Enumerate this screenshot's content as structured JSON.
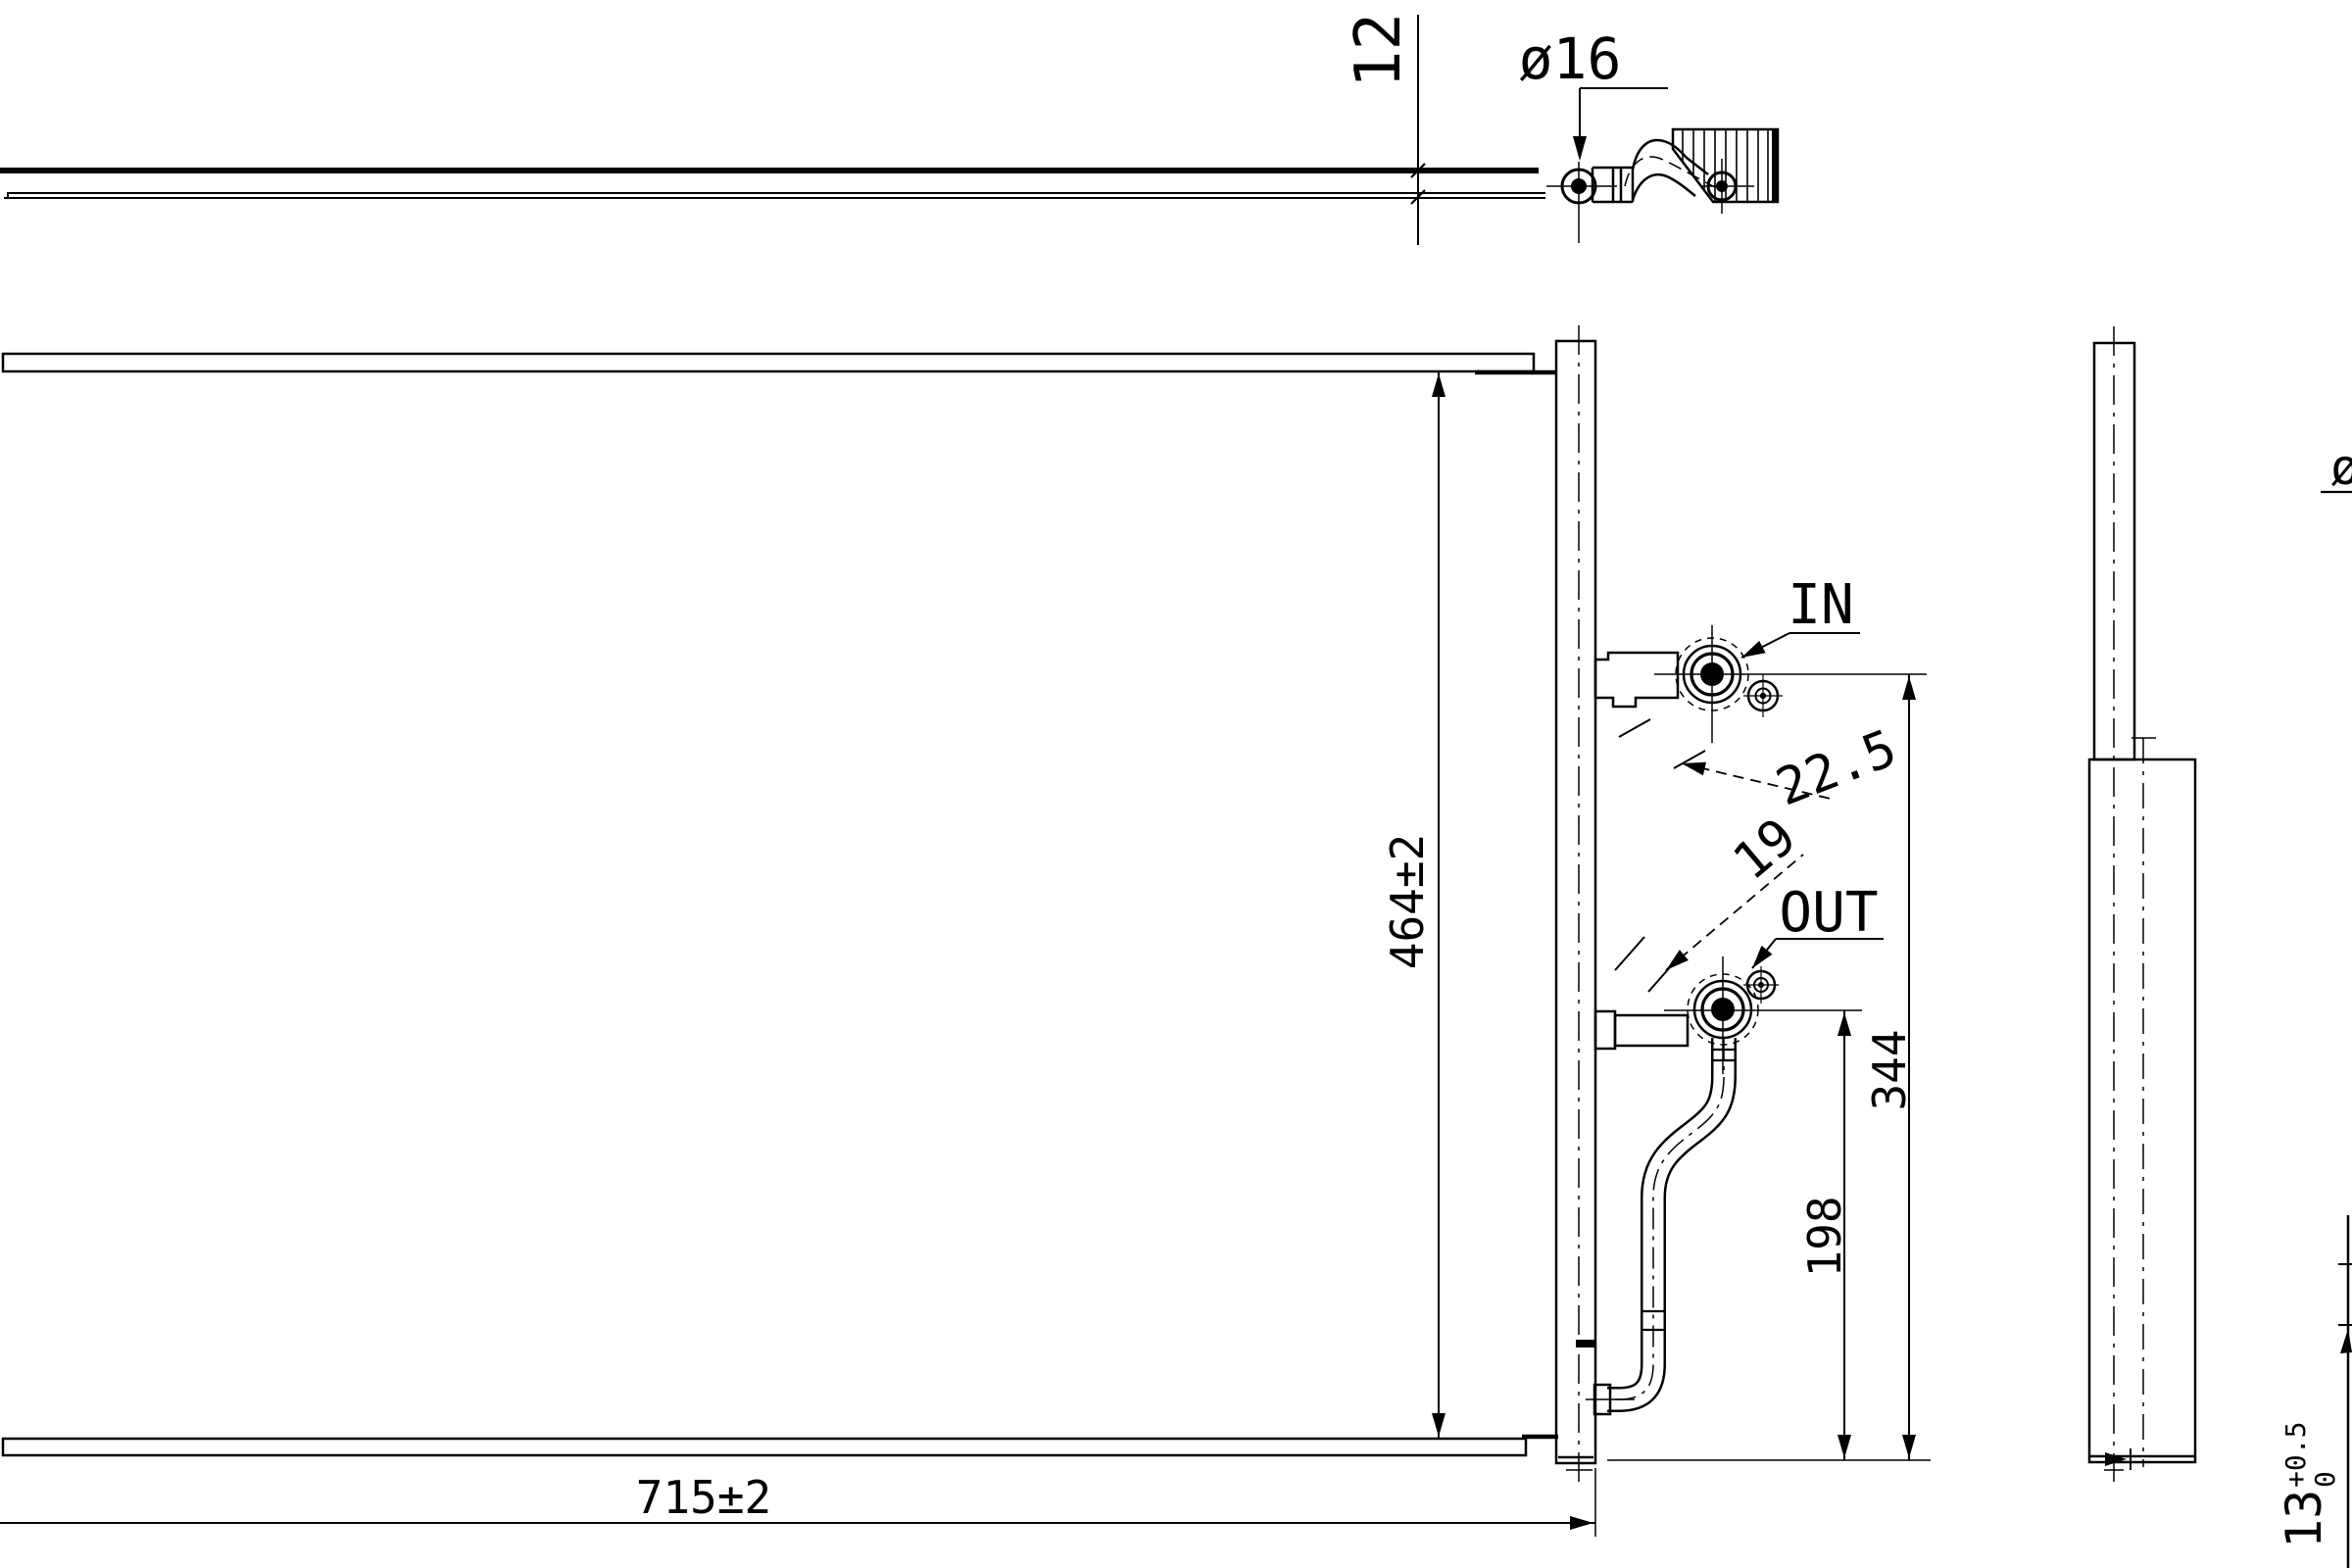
{
  "drawing": {
    "colors": {
      "background": "#ffffff",
      "line": "#000000"
    },
    "top_view": {
      "thickness_dim": "12",
      "pipe_diameter_dim": "ø16"
    },
    "front_view": {
      "width_dim": "715±2",
      "height_dim": "464±2",
      "inlet_label": "IN",
      "outlet_label": "OUT",
      "inlet_angle_dim": "22.5",
      "outlet_size_dim": "19",
      "inlet_center_height_dim": "344",
      "outlet_center_height_dim": "198"
    },
    "side_view": {
      "clipped_diameter_dim": "ø",
      "depth_dim_value": "13",
      "depth_dim_tol_upper": "+0.5",
      "depth_dim_tol_lower": "0"
    }
  }
}
